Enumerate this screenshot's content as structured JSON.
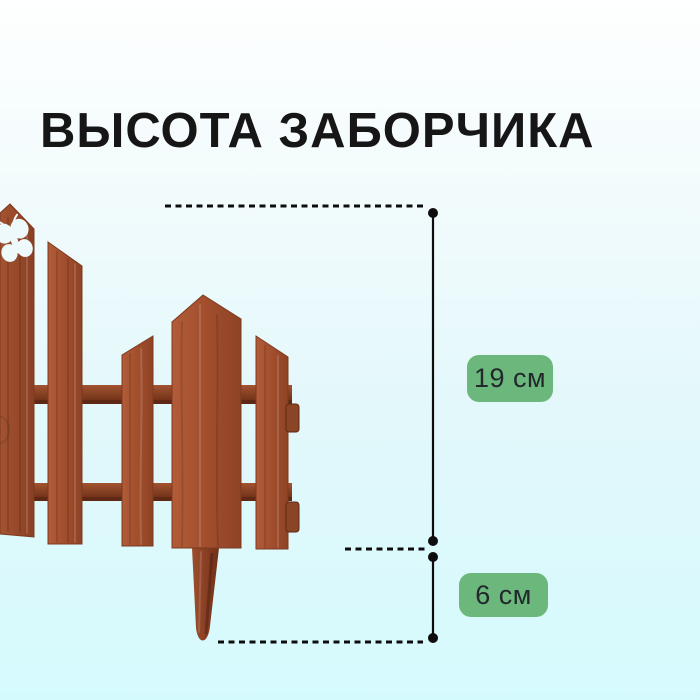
{
  "page": {
    "title": "ВЫСОТА ЗАБОРЧИКА"
  },
  "measurements": {
    "fence_height": {
      "label": "19 см"
    },
    "stake_height": {
      "label": "6 см"
    }
  },
  "icons": {
    "butterfly-icon": "butterfly-shaped cutout in left picket"
  },
  "colors": {
    "background_top": "#feffff",
    "background_bottom": "#d5fafd",
    "title_text": "#161616",
    "badge_green": "#6cb77c",
    "badge_text": "#22282c",
    "line_black": "#0d0d0d",
    "fence_light": "#b25c38",
    "fence_base": "#a04d2c",
    "fence_dark": "#7c3a20",
    "rail_dark": "#8a4426",
    "rail_shadow": "#5e2814"
  }
}
